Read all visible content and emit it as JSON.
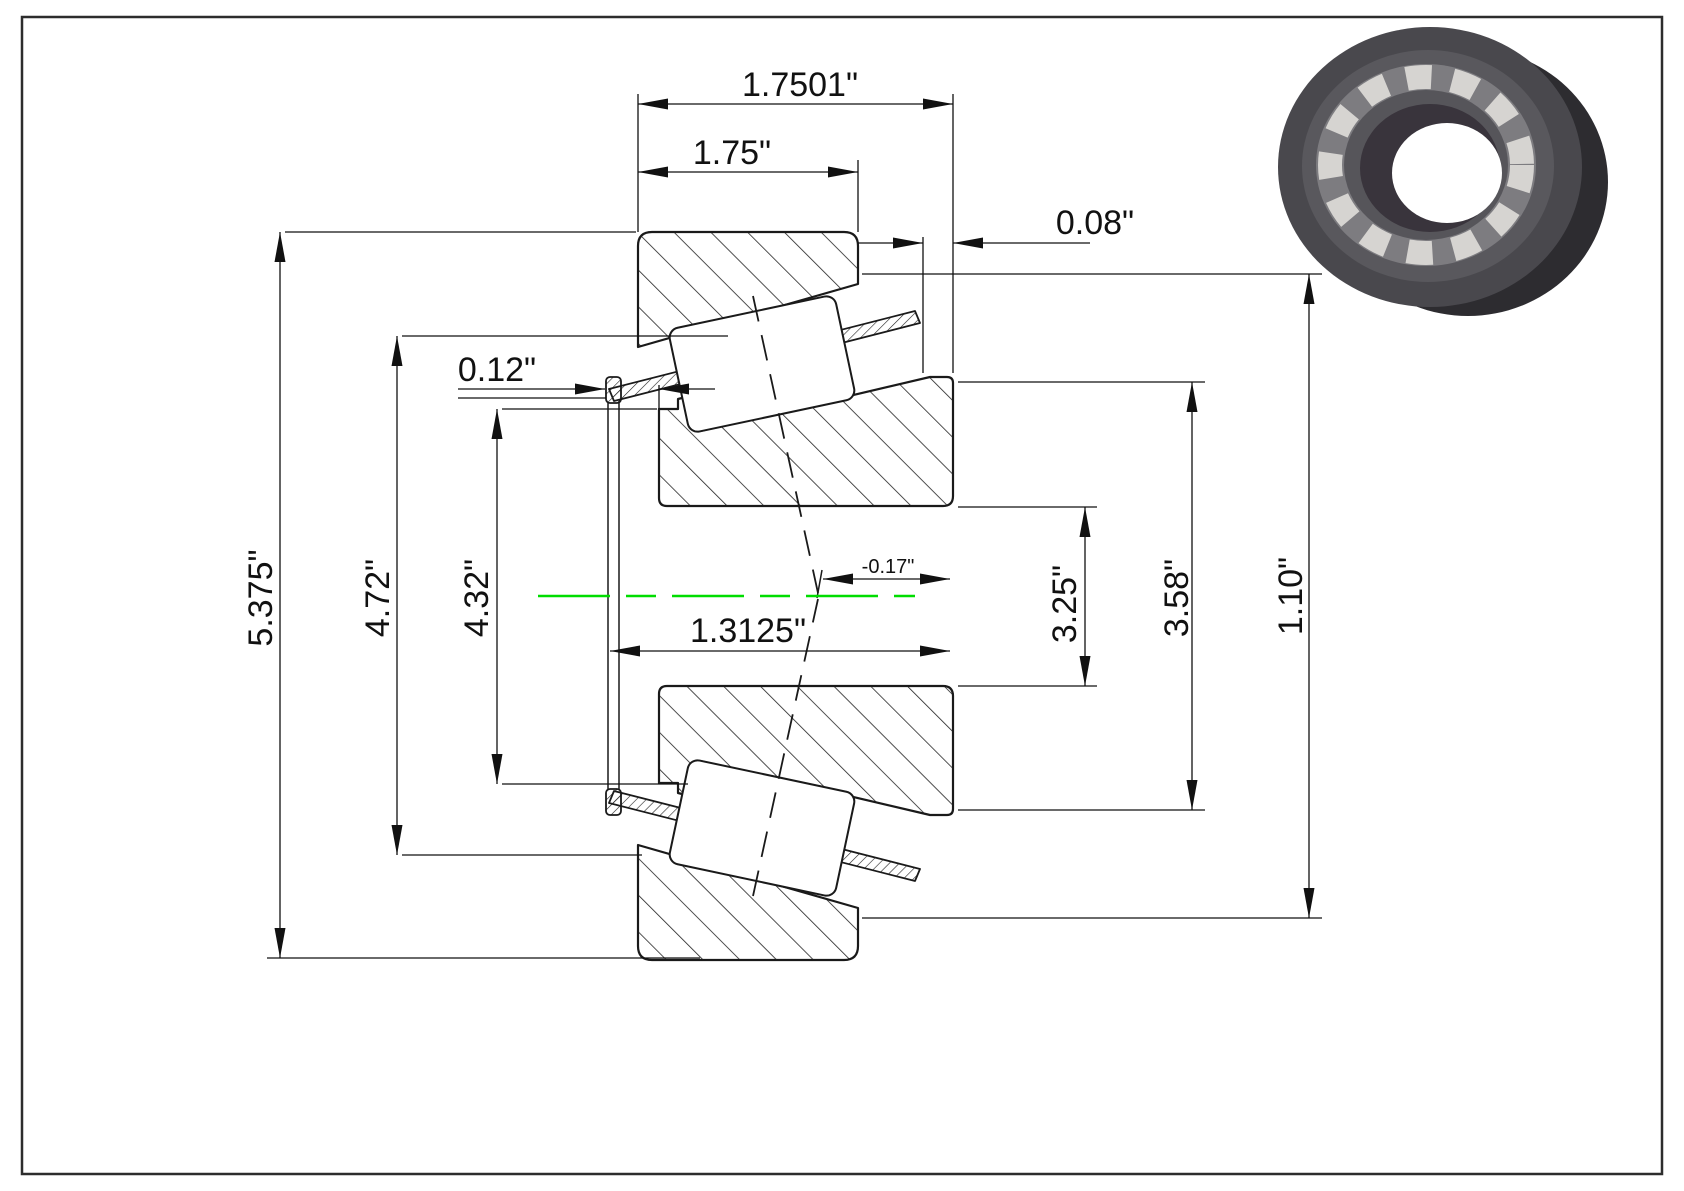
{
  "page": {
    "background": "#ffffff",
    "border_color": "#2d2d2d"
  },
  "drawing": {
    "type": "tapered-roller-bearing-cross-section",
    "centerline_color": "#00dd00",
    "dimensions": {
      "overall_width": "1.7501\"",
      "cup_width": "1.75\"",
      "cup_back_offset": "0.08\"",
      "cage_protrusion": "0.12\"",
      "outer_diameter": "5.375\"",
      "cage_diameter": "4.72\"",
      "cone_backface_diameter": "4.32\"",
      "bore_length": "1.3125\"",
      "apex_offset": "-0.17\"",
      "bore_diameter": "3.25\"",
      "cone_front_diameter": "3.58\"",
      "cup_inner_width": "1.10\""
    }
  }
}
